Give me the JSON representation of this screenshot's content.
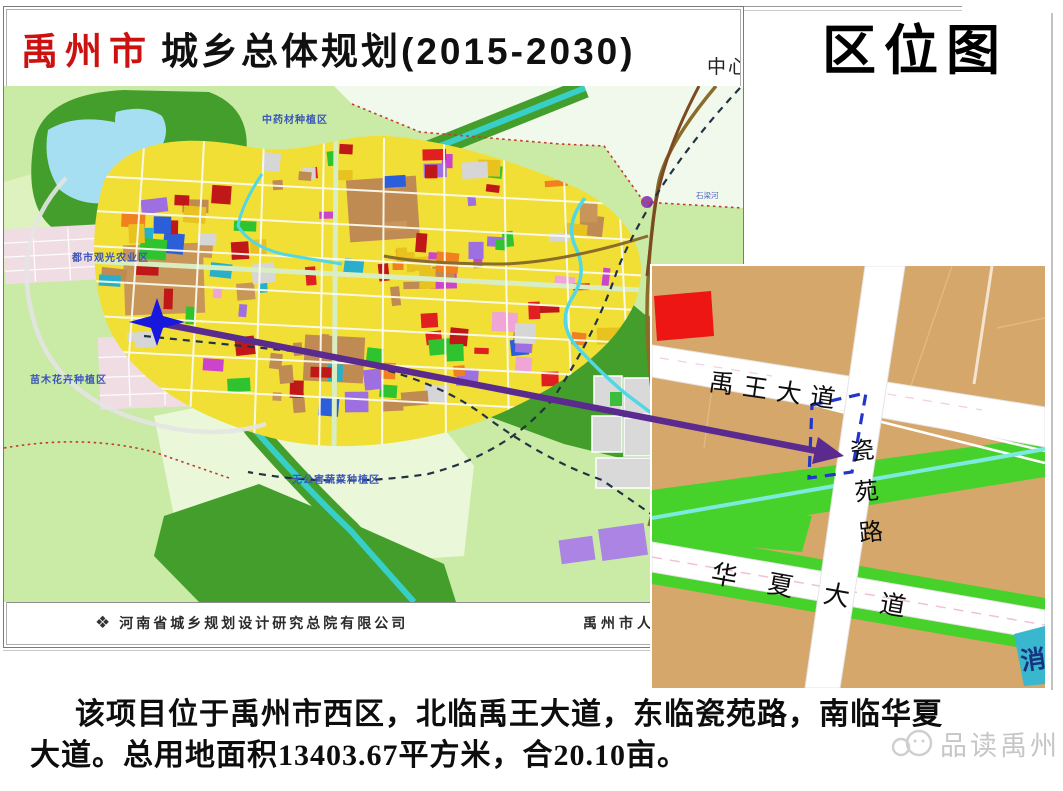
{
  "header": {
    "plan_title_prefix": "禹州市",
    "plan_title_rest": "城乡总体规划(2015-2030)",
    "partial_text": "中心",
    "location_map_title": "区位图"
  },
  "main_map": {
    "labels": {
      "herb_zone": "中药材种植区",
      "agri_sightseeing_zone": "都市观光农业区",
      "seedling_flower_zone": "苗木花卉种植区",
      "vegetable_zone": "无公害蔬菜种植区",
      "river_shiliang": "石梁河"
    },
    "attribution": {
      "logo_glyph": "❖",
      "designer": "河南省城乡规划设计研究总院有限公司",
      "government_partial": "禹州市人"
    },
    "colors": {
      "farmland": "#C9EBA5",
      "pale_zone": "#F1F9EC",
      "forest": "#449E2C",
      "lake": "#A6DFF2",
      "canal": "#38CFC8",
      "river": "#52D7E5",
      "residential_yellow": "#F2DF35",
      "town_pink": "#F0DDE4",
      "urban_palette": [
        "#E02020",
        "#C01818",
        "#E02020",
        "#C08B52",
        "#C99659",
        "#2FC42F",
        "#2FC42F",
        "#F08020",
        "#CC44CC",
        "#EFA6D6",
        "#2B5FD9",
        "#D6D6D6",
        "#2AAFC8",
        "#9E6FE0",
        "#E8C21E",
        "#E8C21E",
        "#C08B52"
      ]
    }
  },
  "inset_map": {
    "roads": {
      "yuwang_avenue": "禹王大道",
      "ciyuan_road": "瓷苑路",
      "huaxia_avenue": "华夏大道"
    },
    "fire_station_partial": "消",
    "colors": {
      "land": "#D6A76B",
      "greenbelt": "#46D22A",
      "stream": "#7CEADC",
      "road": "#FFFFFF",
      "site_outline": "#2336C9",
      "building_red": "#EE1515",
      "parcel_teal": "#38B7CE"
    }
  },
  "annotation": {
    "arrow_color": "#5B2A8E",
    "star_color": "#1717DE"
  },
  "caption": {
    "line1": "该项目位于禹州市西区，北临禹王大道，东临瓷苑路，南临华夏",
    "line2": "大道。总用地面积13403.67平方米，合20.10亩。"
  },
  "watermark": {
    "label": "品读禹州"
  }
}
